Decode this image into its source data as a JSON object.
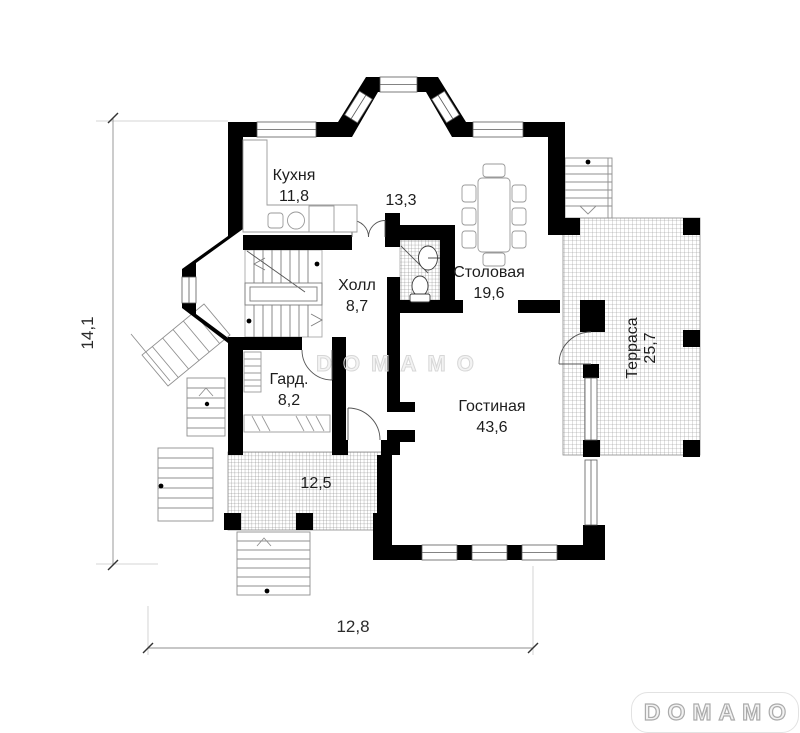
{
  "watermarks": {
    "center": "DOMAMO",
    "corner": "DOMAMO"
  },
  "dimensions": {
    "left": "14,1",
    "bottom": "12,8"
  },
  "rooms": {
    "kitchen": {
      "name": "Кухня",
      "area": "11,8"
    },
    "open": {
      "area": "13,3"
    },
    "dining": {
      "name": "Столовая",
      "area": "19,6"
    },
    "hall": {
      "name": "Холл",
      "area": "8,7"
    },
    "wardrobe": {
      "name": "Гард.",
      "area": "8,2"
    },
    "living": {
      "name": "Гостиная",
      "area": "43,6"
    },
    "terrace": {
      "name": "Терраса",
      "area": "25,7"
    },
    "porch": {
      "area": "12,5"
    }
  },
  "colors": {
    "wall": "#000000",
    "thin_line": "#8a8a8a",
    "furniture_line": "#9a9a9a",
    "text": "#1d1d1d",
    "watermark": "#d7d7d7"
  }
}
